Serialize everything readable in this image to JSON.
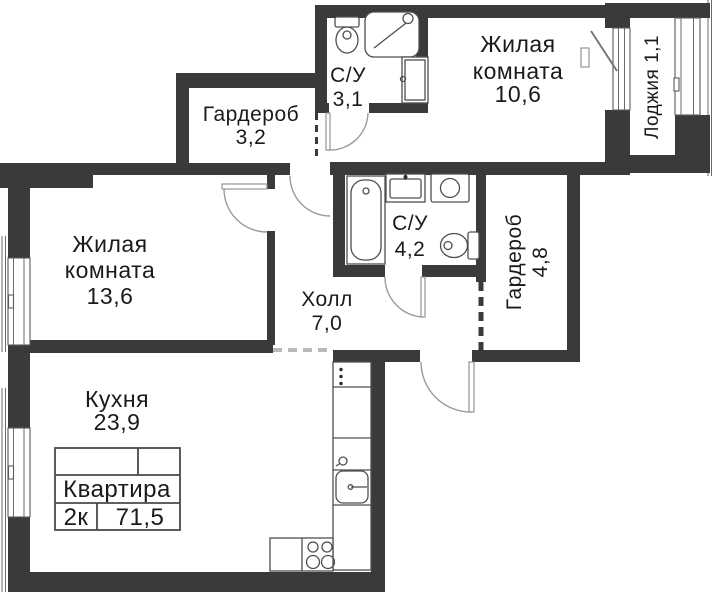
{
  "plan": {
    "rooms": {
      "living_top": {
        "name_line1": "Жилая",
        "name_line2": "комната",
        "area": "10,6"
      },
      "bathroom_top": {
        "name": "С/У",
        "area": "3,1"
      },
      "wardrobe_top": {
        "name": "Гардероб",
        "area": "3,2"
      },
      "loggia": {
        "label": "Лоджия 1,1"
      },
      "living_left": {
        "name_line1": "Жилая",
        "name_line2": "комната",
        "area": "13,6"
      },
      "bathroom_mid": {
        "name": "С/У",
        "area": "4,2"
      },
      "wardrobe_right": {
        "name": "Гардероб",
        "area": "4,8"
      },
      "hall": {
        "name": "Холл",
        "area": "7,0"
      },
      "kitchen": {
        "name": "Кухня",
        "area": "23,9"
      }
    },
    "stamp": {
      "title": "Квартира",
      "rooms_count": "2к",
      "total_area": "71,5"
    },
    "fixtures": [
      "toilet",
      "shower",
      "sink",
      "bathtub",
      "washing-machine",
      "kitchen-counter",
      "kitchen-sink",
      "stove"
    ],
    "colors": {
      "wall": "#3a3a3c",
      "fixture_line": "#4f4f4f",
      "door_arc": "#9b9b9b",
      "text": "#1a1a1a",
      "background": "#ffffff"
    }
  }
}
